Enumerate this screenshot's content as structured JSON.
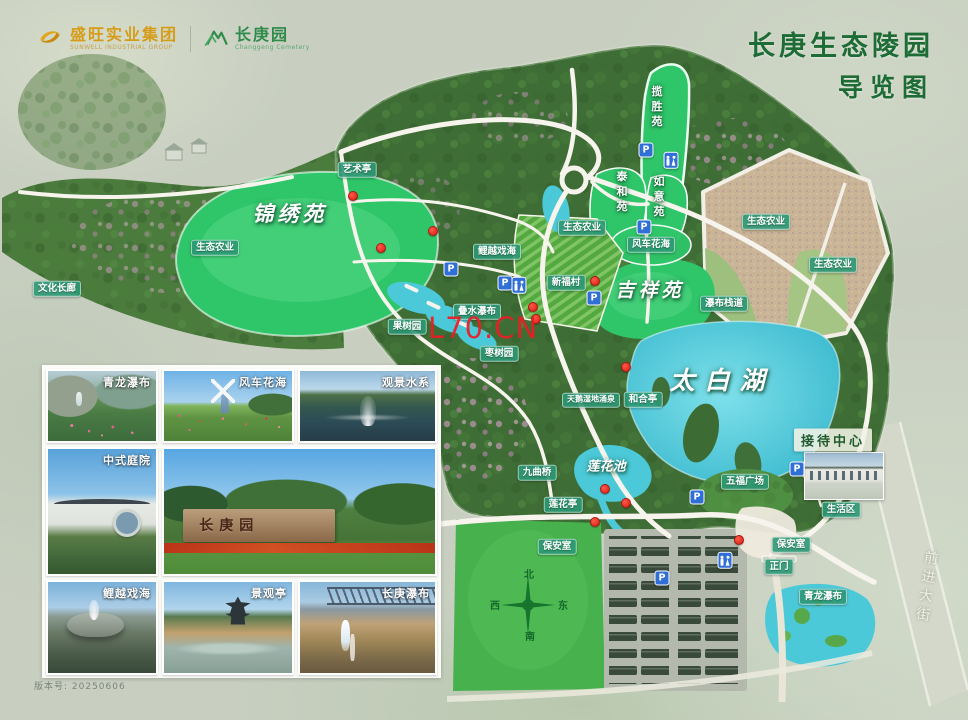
{
  "header": {
    "company_name": "盛旺实业集团",
    "company_sub": "SUNWELL INDUSTRIAL GROUP",
    "park_name": "长庚园",
    "park_sub": "Changgeng Cemetery",
    "title_line1": "长庚生态陵园",
    "title_line2": "导览图",
    "title_color": "#1d6b35",
    "company_color": "#d69c17",
    "park_color": "#2e8b4a"
  },
  "map": {
    "labels": [
      {
        "id": "yishuting",
        "text": "艺术亭",
        "x": 357,
        "y": 170
      },
      {
        "id": "wenhua-changlang",
        "text": "文化长廊",
        "x": 57,
        "y": 289
      },
      {
        "id": "shengtai-nongye-west",
        "text": "生态农业",
        "x": 215,
        "y": 248
      },
      {
        "id": "jinxiuyuan",
        "text": "锦绣苑",
        "x": 290,
        "y": 213,
        "kind": "area",
        "size": 21,
        "spacing": 4
      },
      {
        "id": "liyue-xihai-map",
        "text": "鲤越戏海",
        "x": 497,
        "y": 252
      },
      {
        "id": "lanshengyuan",
        "text": "揽胜苑",
        "x": 656,
        "y": 108,
        "kind": "onfield",
        "vert": true
      },
      {
        "id": "taiheyuan",
        "text": "泰和苑",
        "x": 621,
        "y": 193,
        "kind": "onfield",
        "vert": true
      },
      {
        "id": "ruyiyuan",
        "text": "如意苑",
        "x": 658,
        "y": 198,
        "kind": "onfield",
        "vert": true
      },
      {
        "id": "shengtai-nongye-terrace",
        "text": "生态农业",
        "x": 582,
        "y": 228
      },
      {
        "id": "fengche-huahai-map",
        "text": "风车花海",
        "x": 651,
        "y": 245
      },
      {
        "id": "xinfucun",
        "text": "新福村",
        "x": 566,
        "y": 283
      },
      {
        "id": "shengtai-nongye-east1",
        "text": "生态农业",
        "x": 766,
        "y": 222
      },
      {
        "id": "shengtai-nongye-east2",
        "text": "生态农业",
        "x": 833,
        "y": 265
      },
      {
        "id": "pubu-zhandao",
        "text": "瀑布栈道",
        "x": 724,
        "y": 304
      },
      {
        "id": "jixiangyuan",
        "text": "吉祥苑",
        "x": 650,
        "y": 289,
        "kind": "area",
        "size": 19,
        "spacing": 4
      },
      {
        "id": "dieshui-pubu",
        "text": "叠水瀑布",
        "x": 477,
        "y": 312
      },
      {
        "id": "guoshuyuan",
        "text": "果树园",
        "x": 407,
        "y": 327
      },
      {
        "id": "zaoshuyuan",
        "text": "枣树园",
        "x": 499,
        "y": 354
      },
      {
        "id": "taibaihu",
        "text": "太白湖",
        "x": 722,
        "y": 379,
        "kind": "area",
        "size": 25,
        "spacing": 10
      },
      {
        "id": "tiane-shidi-yongquan",
        "text": "天鹅湿地涌泉",
        "x": 591,
        "y": 400,
        "size": 8
      },
      {
        "id": "heheting",
        "text": "和合亭",
        "x": 643,
        "y": 400
      },
      {
        "id": "jiedai-zhongxin",
        "text": "接待中心",
        "x": 833,
        "y": 440,
        "kind": "reception"
      },
      {
        "id": "lianhuachi",
        "text": "莲花池",
        "x": 606,
        "y": 465,
        "kind": "area",
        "size": 13
      },
      {
        "id": "jiuquqiao",
        "text": "九曲桥",
        "x": 537,
        "y": 473
      },
      {
        "id": "wufu-guangchang",
        "text": "五福广场",
        "x": 745,
        "y": 482
      },
      {
        "id": "shenghuoqu",
        "text": "生活区",
        "x": 841,
        "y": 510
      },
      {
        "id": "lianhuating",
        "text": "莲花亭",
        "x": 563,
        "y": 505
      },
      {
        "id": "baoanshi-west",
        "text": "保安室",
        "x": 557,
        "y": 547
      },
      {
        "id": "baoanshi-east",
        "text": "保安室",
        "x": 791,
        "y": 545
      },
      {
        "id": "zhengmen",
        "text": "正门",
        "x": 779,
        "y": 567
      },
      {
        "id": "qinglong-pubu-map",
        "text": "青龙瀑布",
        "x": 823,
        "y": 597
      }
    ],
    "parking_letter": "P",
    "parking": [
      [
        646,
        150
      ],
      [
        644,
        227
      ],
      [
        451,
        269
      ],
      [
        505,
        283
      ],
      [
        594,
        298
      ],
      [
        797,
        469
      ],
      [
        697,
        497
      ],
      [
        662,
        578
      ]
    ],
    "restrooms": [
      [
        671,
        160
      ],
      [
        519,
        285
      ],
      [
        725,
        560
      ]
    ],
    "markers": [
      [
        353,
        196
      ],
      [
        433,
        231
      ],
      [
        381,
        248
      ],
      [
        595,
        281
      ],
      [
        533,
        307
      ],
      [
        536,
        319
      ],
      [
        626,
        367
      ],
      [
        605,
        489
      ],
      [
        626,
        503
      ],
      [
        595,
        522
      ],
      [
        739,
        540
      ]
    ],
    "compass": {
      "north": "北",
      "south": "南",
      "east": "东",
      "west": "西"
    },
    "road_name": "前进大街"
  },
  "gallery": {
    "photos": [
      {
        "scene": "qinglong",
        "label": "青龙瀑布",
        "x": 46,
        "y": 369,
        "w": 112,
        "h": 74
      },
      {
        "scene": "windmill",
        "label": "风车花海",
        "x": 162,
        "y": 369,
        "w": 132,
        "h": 74
      },
      {
        "scene": "fountain",
        "label": "观景水系",
        "x": 298,
        "y": 369,
        "w": 139,
        "h": 74
      },
      {
        "scene": "courtyard",
        "label": "中式庭院",
        "x": 46,
        "y": 447,
        "w": 112,
        "h": 129
      },
      {
        "scene": "entrance",
        "label": "",
        "wall_text": "长庚园",
        "x": 162,
        "y": 447,
        "w": 275,
        "h": 129
      },
      {
        "scene": "koi",
        "label": "鲤越戏海",
        "x": 46,
        "y": 580,
        "w": 112,
        "h": 95
      },
      {
        "scene": "pavilion",
        "label": "景观亭",
        "x": 162,
        "y": 580,
        "w": 132,
        "h": 95
      },
      {
        "scene": "falls",
        "label": "长庚瀑布",
        "x": 298,
        "y": 580,
        "w": 139,
        "h": 95
      }
    ]
  },
  "watermark": "L70.CN",
  "version": "版本号: 20250606"
}
